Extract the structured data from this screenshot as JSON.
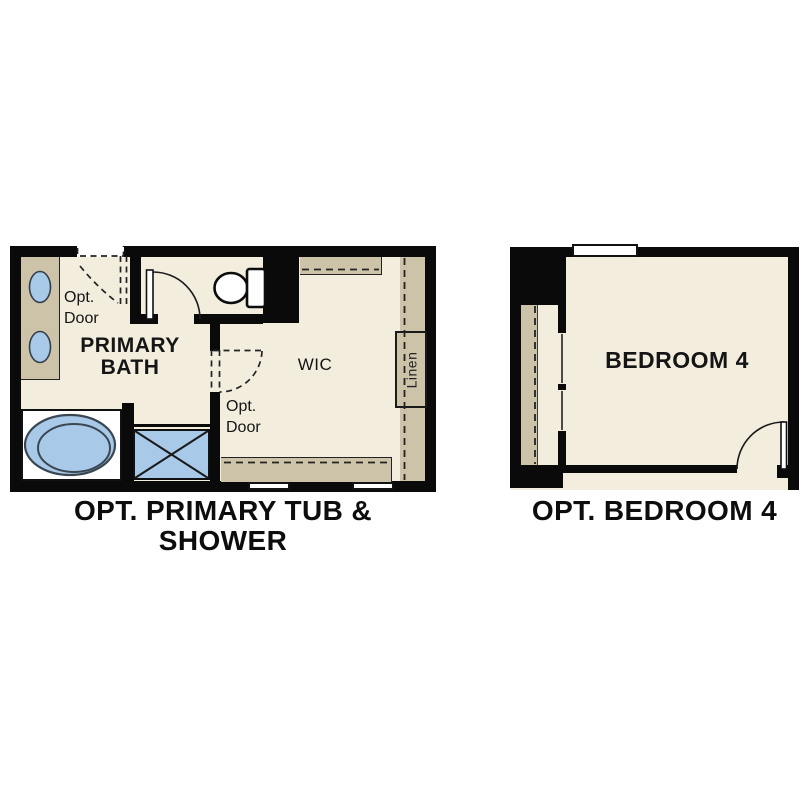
{
  "colors": {
    "wall": "#0a0a0a",
    "floor": "#f3edde",
    "counter_tan": "#cdc3a8",
    "fixture_blue": "#a9c9e9",
    "page_bg": "#ffffff"
  },
  "left_plan": {
    "caption_line1": "OPT. PRIMARY TUB &",
    "caption_line2": "SHOWER",
    "room_label_line1": "PRIMARY",
    "room_label_line2": "BATH",
    "wic_label": "WIC",
    "linen_label": "Linen",
    "opt_door_top": {
      "line1": "Opt.",
      "line2": "Door"
    },
    "opt_door_mid": {
      "line1": "Opt.",
      "line2": "Door"
    }
  },
  "right_plan": {
    "caption": "OPT. BEDROOM 4",
    "room_label": "BEDROOM 4"
  }
}
